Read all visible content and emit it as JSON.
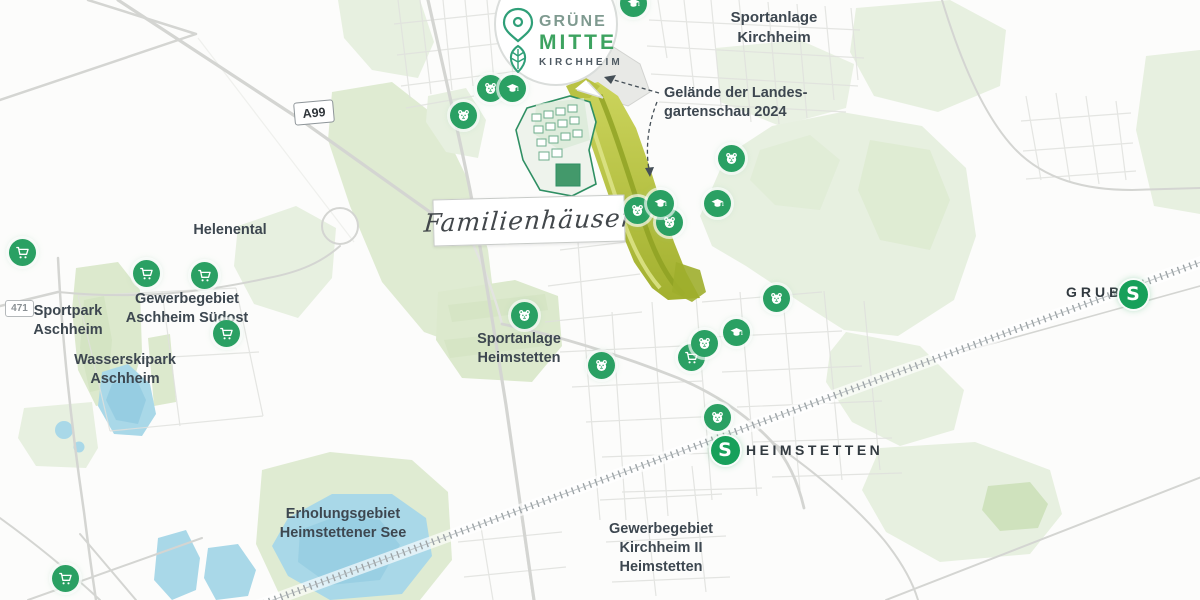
{
  "logo": {
    "line1": "GRÜNE",
    "line2": "MITTE",
    "line3": "KIRCHHEIM"
  },
  "callouts": {
    "site_line1": "Gelände der Landes-",
    "site_line2": "gartenschau 2024",
    "familienhaeuser": "Familienhäuser"
  },
  "area_labels": {
    "sportanlage_kirchheim": [
      "Sportanlage",
      "Kirchheim"
    ],
    "helenental": [
      "Helenental"
    ],
    "gewerbegebiet_aschheim": [
      "Gewerbegebiet",
      "Aschheim Südost"
    ],
    "sportpark_aschheim": [
      "Sportpark",
      "Aschheim"
    ],
    "wasserskipark_aschheim": [
      "Wasserskipark",
      "Aschheim"
    ],
    "sportanlage_heimstetten": [
      "Sportanlage",
      "Heimstetten"
    ],
    "erholungsgebiet": [
      "Erholungsgebiet",
      "Heimstettener See"
    ],
    "gewerbegebiet_kirchheim": [
      "Gewerbegebiet",
      "Kirchheim II",
      "Heimstetten"
    ]
  },
  "road_badges": {
    "autobahn": "A99",
    "bundesstrasse": "471"
  },
  "stations": {
    "letter": "S",
    "grub": "GRUB",
    "heimstetten": "HEIMSTETTEN"
  },
  "marker_types": {
    "cart": "shopping-cart",
    "bear": "bear-face",
    "cap": "graduation-cap"
  },
  "markers": [
    {
      "type": "cart",
      "x": 22,
      "y": 252
    },
    {
      "type": "cart",
      "x": 146,
      "y": 273
    },
    {
      "type": "cart",
      "x": 204,
      "y": 275
    },
    {
      "type": "cart",
      "x": 226,
      "y": 333
    },
    {
      "type": "cart",
      "x": 691,
      "y": 357
    },
    {
      "type": "cart",
      "x": 65,
      "y": 578
    },
    {
      "type": "bear",
      "x": 463,
      "y": 115
    },
    {
      "type": "bear",
      "x": 490,
      "y": 88
    },
    {
      "type": "bear",
      "x": 731,
      "y": 158
    },
    {
      "type": "bear",
      "x": 637,
      "y": 210
    },
    {
      "type": "bear",
      "x": 669,
      "y": 222
    },
    {
      "type": "bear",
      "x": 524,
      "y": 315
    },
    {
      "type": "bear",
      "x": 601,
      "y": 365
    },
    {
      "type": "bear",
      "x": 704,
      "y": 343
    },
    {
      "type": "bear",
      "x": 776,
      "y": 298
    },
    {
      "type": "bear",
      "x": 717,
      "y": 417
    },
    {
      "type": "cap",
      "x": 512,
      "y": 88
    },
    {
      "type": "cap",
      "x": 660,
      "y": 203
    },
    {
      "type": "cap",
      "x": 717,
      "y": 203
    },
    {
      "type": "cap",
      "x": 736,
      "y": 332
    },
    {
      "type": "cap",
      "x": 633,
      "y": 3
    }
  ],
  "colors": {
    "marker_green": "#2aa063",
    "sbahn_green": "#17a05a",
    "logo_green": "#3da360",
    "logo_gray_green": "#7f9a90",
    "label_text": "#3d4750",
    "site_olive": "#b7c13e",
    "park_green": "#e7f0e0",
    "lake_blue": "#a9d8e8"
  }
}
